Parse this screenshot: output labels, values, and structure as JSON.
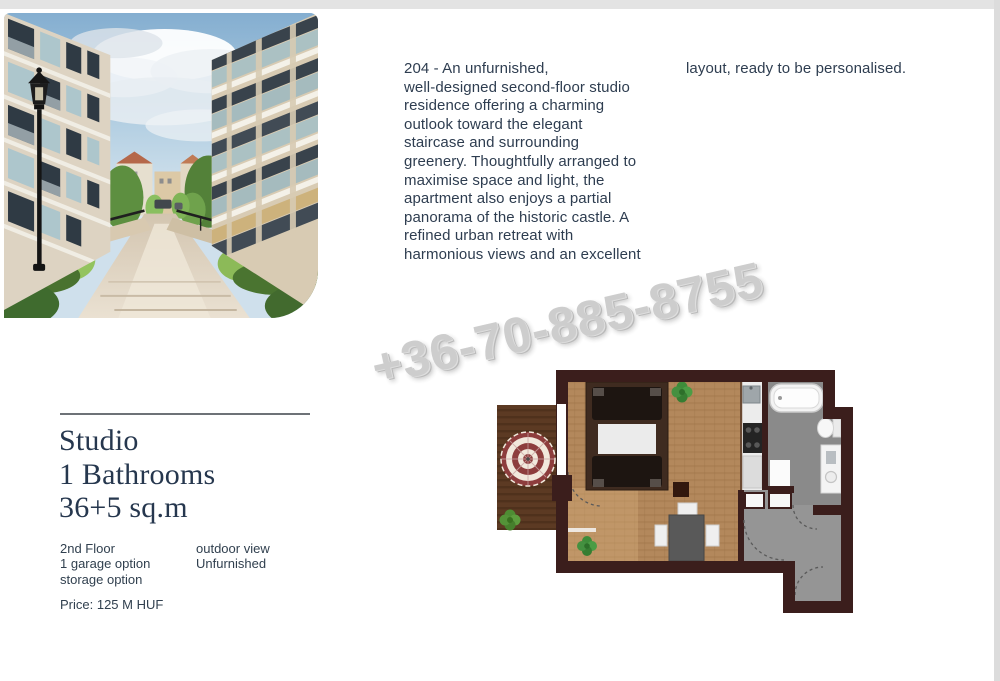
{
  "watermark": {
    "text": "+36-70-885-8755"
  },
  "description": {
    "col1": "204 - An unfurnished,\nwell-designed second-floor studio\nresidence offering a charming\noutlook toward the elegant\nstaircase and surrounding\ngreenery. Thoughtfully arranged to\nmaximise space and light, the\napartment also enjoys a partial\npanorama of the historic castle. A\nrefined urban retreat with\nharmonious views and an excellent",
    "col2": "layout, ready to be personalised."
  },
  "listing": {
    "title_lines": [
      "Studio",
      "1 Bathrooms",
      "36+5 sq.m"
    ],
    "features_left": [
      "2nd Floor",
      "1 garage option",
      "storage option"
    ],
    "features_right": [
      "outdoor view",
      "Unfurnished"
    ],
    "price": "Price: 125 M HUF"
  },
  "colors": {
    "heading": "#26374e",
    "body_text": "#2e3d50",
    "watermark_gray": "#c9c9c9",
    "floorplan_wall": "#3b1e1c",
    "floorplan_wood": "#b3885c",
    "floorplan_balcony_wood": "#5c3a23",
    "floorplan_tile_gray": "#8d8d8d"
  },
  "floorplan": {
    "elements": [
      "balcony",
      "parasol",
      "double-bed",
      "dining-table",
      "kitchenette",
      "bathtub",
      "toilet",
      "washing-machine",
      "entry-hall",
      "plants"
    ]
  }
}
